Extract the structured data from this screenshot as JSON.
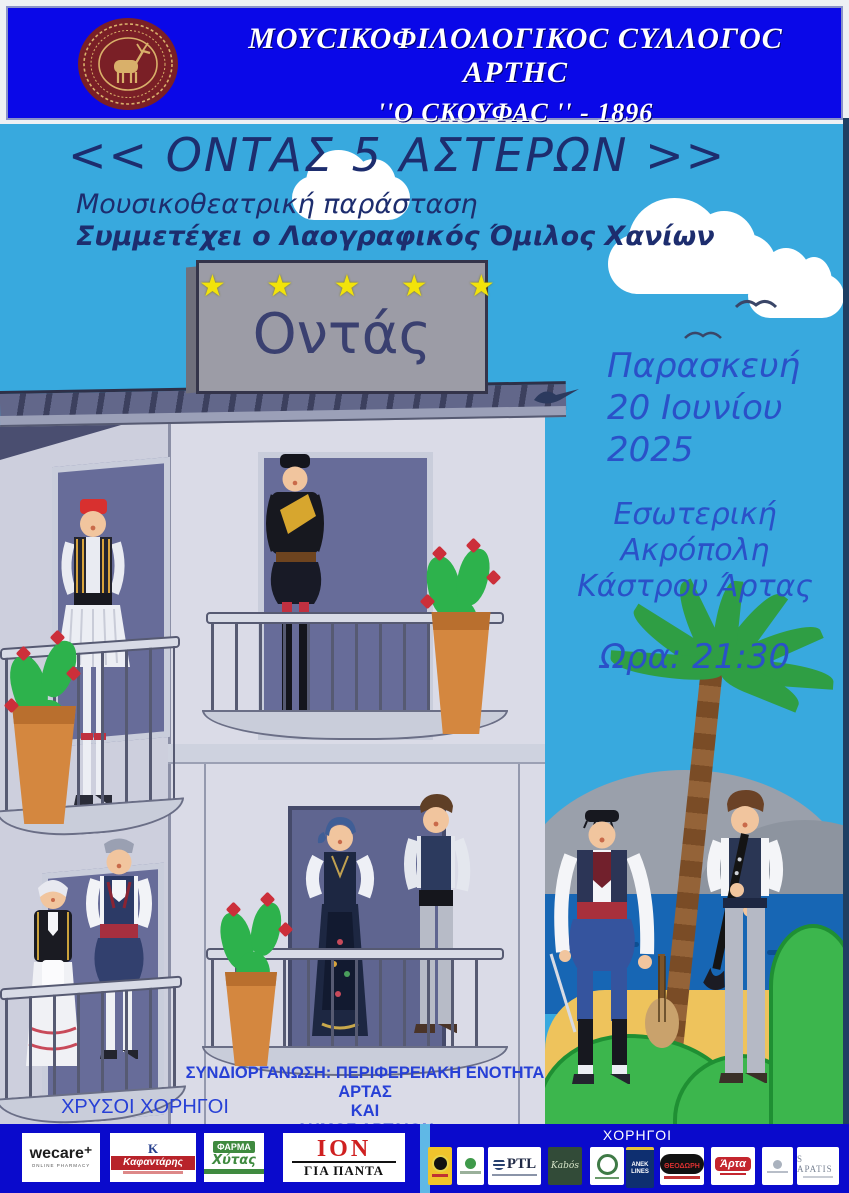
{
  "header": {
    "line1": "ΜΟΥCΙΚΟΦΙΛΟΛΟΓΙΚΟC CΥΛΛΟΓΟC ΑΡΤΗC",
    "line2": "''Ο CΚΟΥΦΑC '' - 1896"
  },
  "title": "<< ΟΝΤΑΣ 5 ΑΣΤΕΡΩΝ >>",
  "subtitle1": "Μουσικοθεατρική παράσταση",
  "subtitle2": "Συμμετέχει ο Λαογραφικός Όμιλος Χανίων",
  "sign": {
    "stars": "★ ★ ★ ★ ★",
    "text": "Οντάς"
  },
  "event": {
    "day": "Παρασκευή",
    "date": "20 Ιουνίου",
    "year": "2025",
    "venue1": "Εσωτερική Ακρόπολη",
    "venue2": "Κάστρου Άρτας",
    "time": "Ωρα: 21:30"
  },
  "organizers": {
    "line1": "ΣΥΝΔΙΟΡΓΑΝΩΣΗ: ΠΕΡΙΦΕΡΕΙΑΚΗ ΕΝΟΤΗΤΑ ΑΡΤΑΣ",
    "line2": "ΚΑΙ",
    "line3": "ΔΗΜΟΣ ΑΡΤΑΙΩΝ"
  },
  "sponsors": {
    "gold_label": "ΧΡΥΣΟΙ ΧΟΡΗΓΟΙ",
    "label": "ΧΟΡΗΓΟΙ",
    "gold": [
      {
        "line1": "wecare⁺",
        "line2": "ONLINE PHARMACY"
      },
      {
        "line1": "Κ",
        "line2": "Καφαντάρης"
      },
      {
        "line1": "ΦΑΡΜΑ",
        "line2": "Χύτας"
      },
      {
        "line1": "ΙΟΝ",
        "line2": "ΓΙΑ ΠΑΝΤΑ"
      }
    ],
    "small": [
      {
        "text": ""
      },
      {
        "text": ""
      },
      {
        "text": "PTL"
      },
      {
        "text": "Kabós"
      },
      {
        "text": ""
      },
      {
        "text": "ANEK LINES"
      },
      {
        "text": "ΘΕΟΔΩΡΗ"
      },
      {
        "text": "Άρτα"
      },
      {
        "text": ""
      },
      {
        "text": "S APATIS"
      }
    ]
  },
  "colors": {
    "header_blue": "#0a08e8",
    "sky_blue": "#38a9de",
    "footer_blue": "#0a0acc",
    "title_navy": "#1d2d6e",
    "ink_blue": "#2a51c8",
    "star_yellow": "#f2e30a",
    "building_gray": "#dadbe7",
    "roof_slate": "#3c405e",
    "door_purple": "#676c99",
    "sea_blue": "#1766b4",
    "sand": "#eec35c",
    "bush_green": "#3cb64d",
    "pot_terracotta": "#d4873f",
    "seal_maroon": "#7a1f26"
  }
}
